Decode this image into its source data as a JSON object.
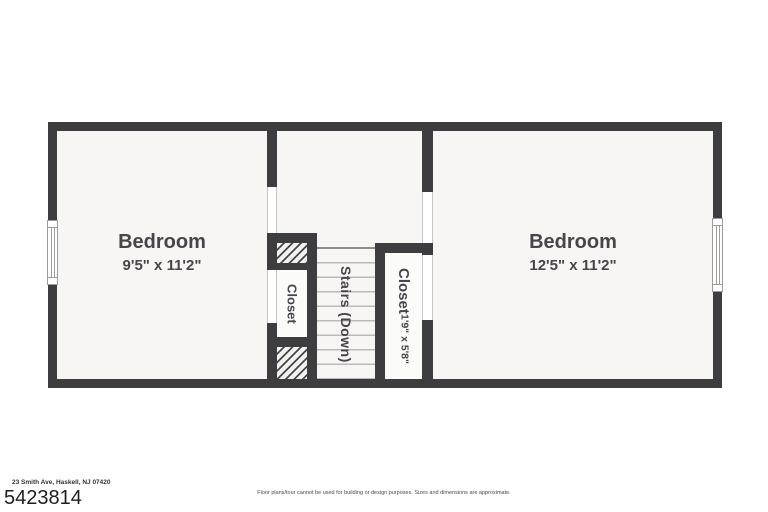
{
  "theme": {
    "wall_color": "#3d3d3f",
    "floor_color": "#f7f6f4",
    "label_color": "#46464a",
    "stair_tread_color": "#b9b9b9"
  },
  "rooms": {
    "bedroom_left": {
      "label": "Bedroom",
      "dimensions": "9'5\" x 11'2\""
    },
    "bedroom_right": {
      "label": "Bedroom",
      "dimensions": "12'5\" x 11'2\""
    },
    "closet_left": {
      "label": "Closet"
    },
    "closet_right": {
      "label": "Closet",
      "dimensions": "1'9\" x 5'8\""
    },
    "stairs": {
      "label": "Stairs (Down)"
    }
  },
  "footer": {
    "address": "23 Smith Ave, Haskell, NJ 07420",
    "listing_number": "5423814",
    "disclaimer": "Floor plans/tour cannot be used for building or design purposes. Sizes and dimensions are approximate."
  }
}
